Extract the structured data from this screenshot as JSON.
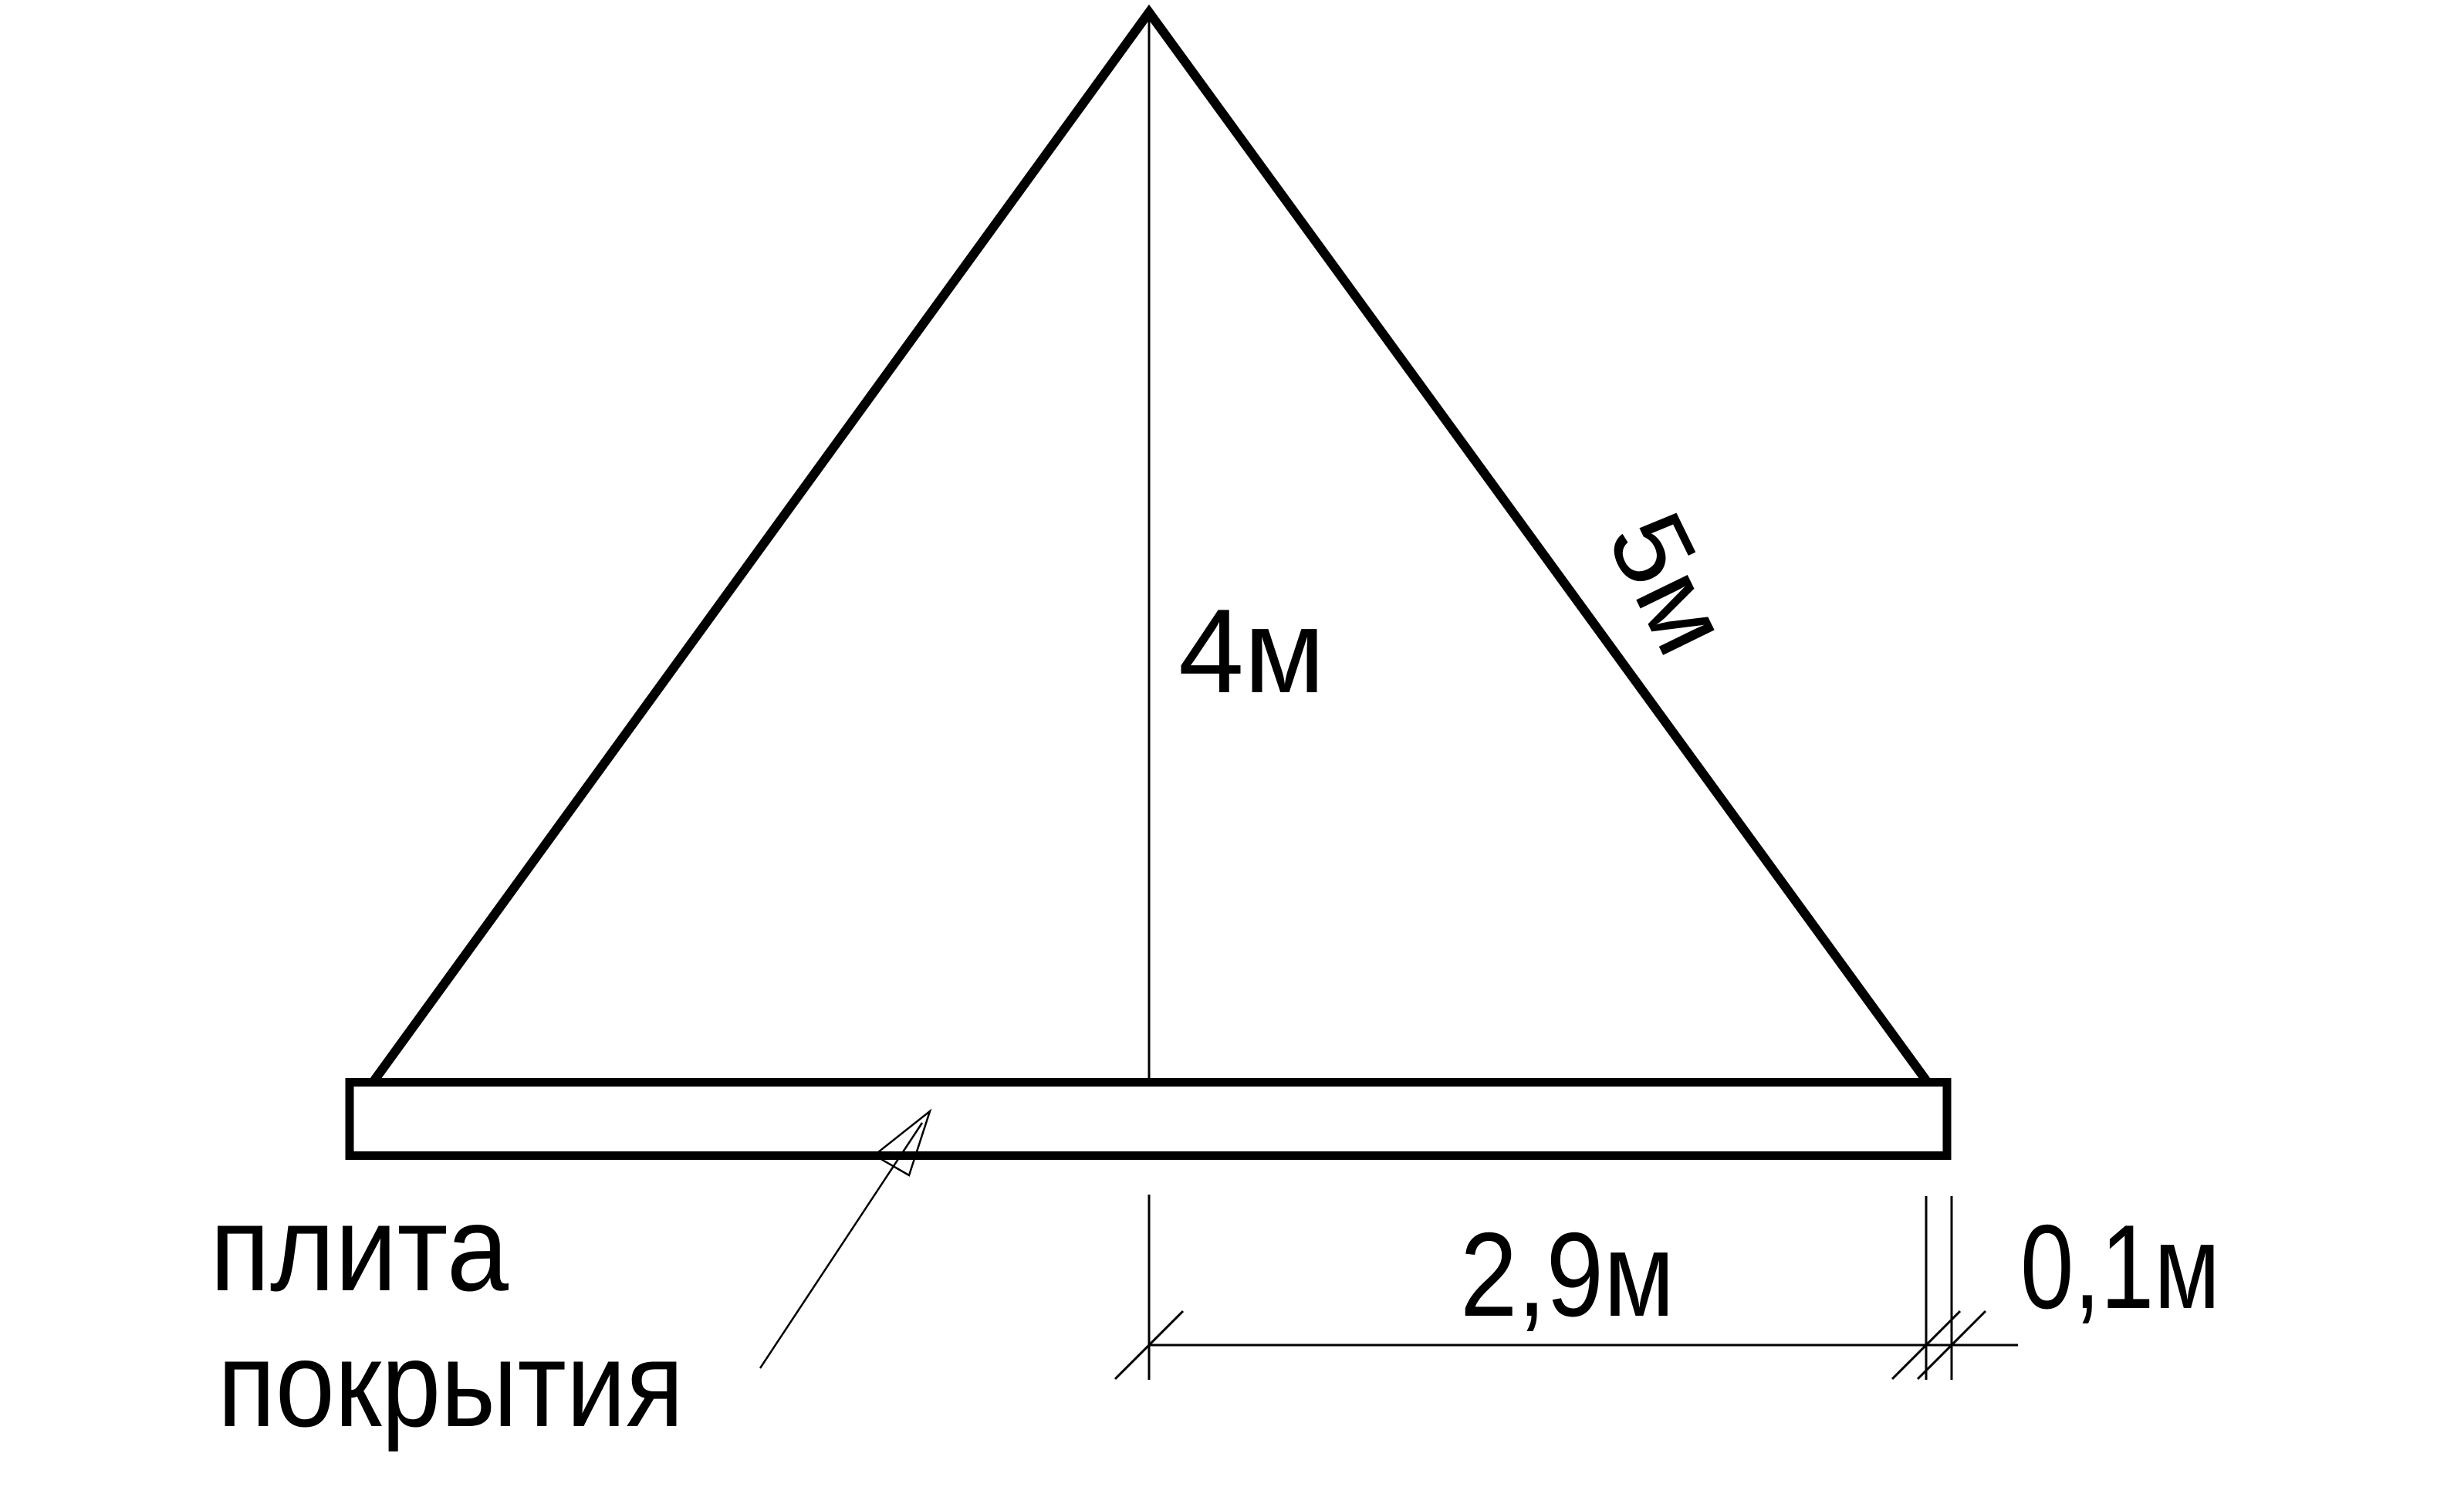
{
  "drawing": {
    "background_color": "#ffffff",
    "line_color": "#000000",
    "labels": {
      "height": "4м",
      "slope": "5м",
      "half_span": "2,9м",
      "overhang": "0,1м",
      "slab_line1": "плита",
      "slab_line2": "покрытия"
    }
  }
}
